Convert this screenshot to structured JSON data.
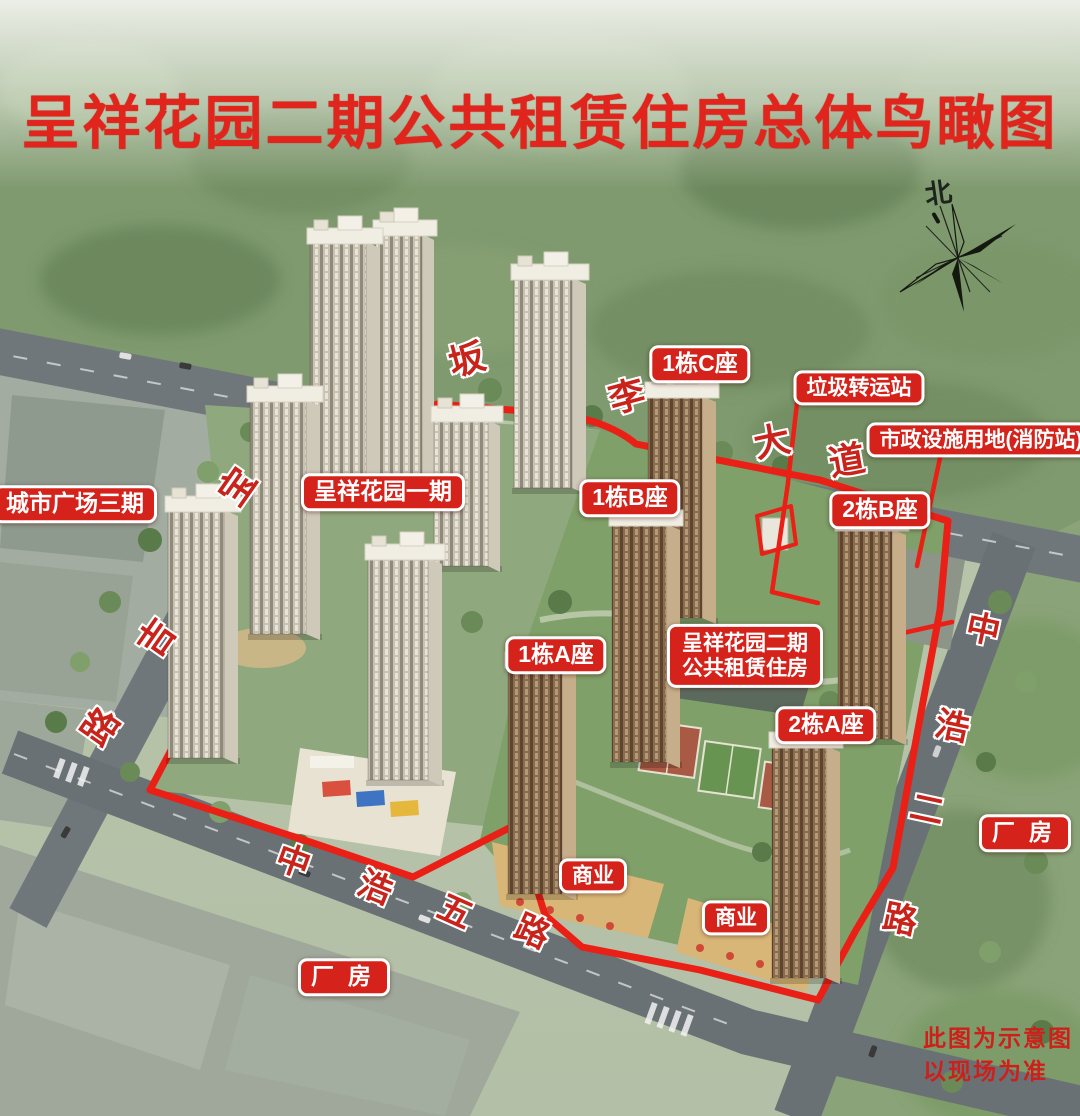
{
  "title": "呈祥花园二期公共租赁住房总体鸟瞰图",
  "compass": {
    "north": "北"
  },
  "labels": {
    "city_plaza3": "城市广场三期",
    "phase1": "呈祥花园一期",
    "t1c": "1栋C座",
    "trash": "垃圾转运站",
    "municipal": "市政设施用地(消防站)",
    "t1b": "1栋B座",
    "t2b": "2栋B座",
    "t1a": "1栋A座",
    "phase2_l1": "呈祥花园二期",
    "phase2_l2": "公共租赁住房",
    "t2a": "2栋A座",
    "biz1": "商业",
    "biz2": "商业",
    "factory_sw": "厂房",
    "factory_e": "厂房"
  },
  "roads": {
    "banli": [
      "坂",
      "李",
      "大",
      "道"
    ],
    "baoji": [
      "宝",
      "吉",
      "路"
    ],
    "zhonghao5": [
      "中",
      "浩",
      "五",
      "路"
    ],
    "zhonghao2": [
      "中",
      "浩",
      "二",
      "路"
    ]
  },
  "disclaimer": {
    "l1": "此图为示意图",
    "l2": "以现场为准"
  },
  "colors": {
    "title_red": "#e1251c",
    "label_bg_red": "#d5231b",
    "road_char_red": "#c9241c",
    "boundary_red": "#ea1f15",
    "forest_green": "#7f9a6f"
  }
}
